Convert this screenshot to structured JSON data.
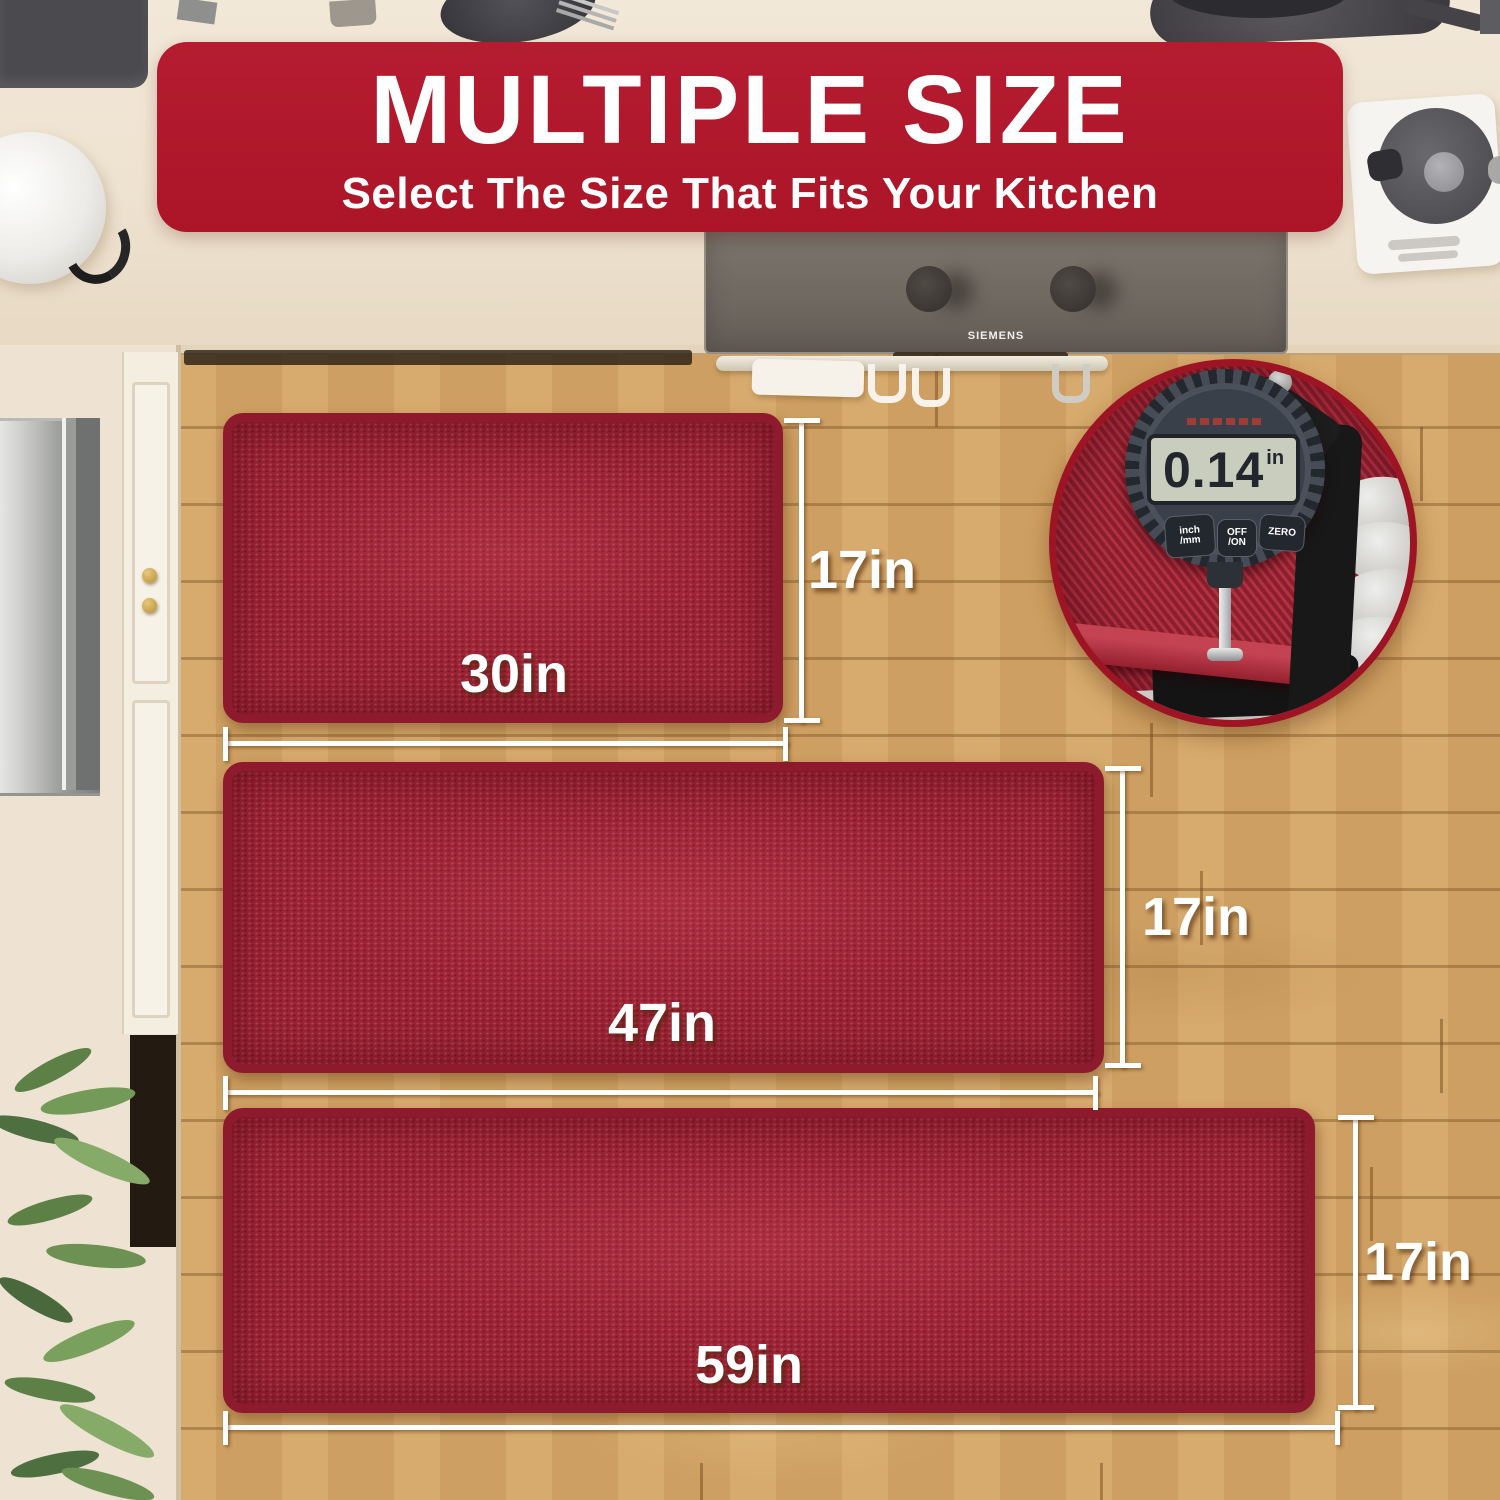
{
  "banner": {
    "title": "MULTIPLE SIZE",
    "subtitle": "Select The Size That Fits Your Kitchen"
  },
  "mats": [
    {
      "width_label": "30in",
      "height_label": "17in"
    },
    {
      "width_label": "47in",
      "height_label": "17in"
    },
    {
      "width_label": "59in",
      "height_label": "17in"
    }
  ],
  "gauge": {
    "value": "0.14",
    "unit": "in",
    "buttons": [
      {
        "top": "inch",
        "bottom": "/mm"
      },
      {
        "top": "OFF",
        "bottom": "/ON"
      },
      {
        "top": "ZERO",
        "bottom": ""
      }
    ]
  },
  "hood": {
    "brand": "SIEMENS"
  },
  "colors": {
    "banner_red": "#b01b2e",
    "mat_red": "#9c2334",
    "inset_rim_red": "#9d1424",
    "wood": "#d5a565",
    "counter_beige": "#eee3d2"
  }
}
